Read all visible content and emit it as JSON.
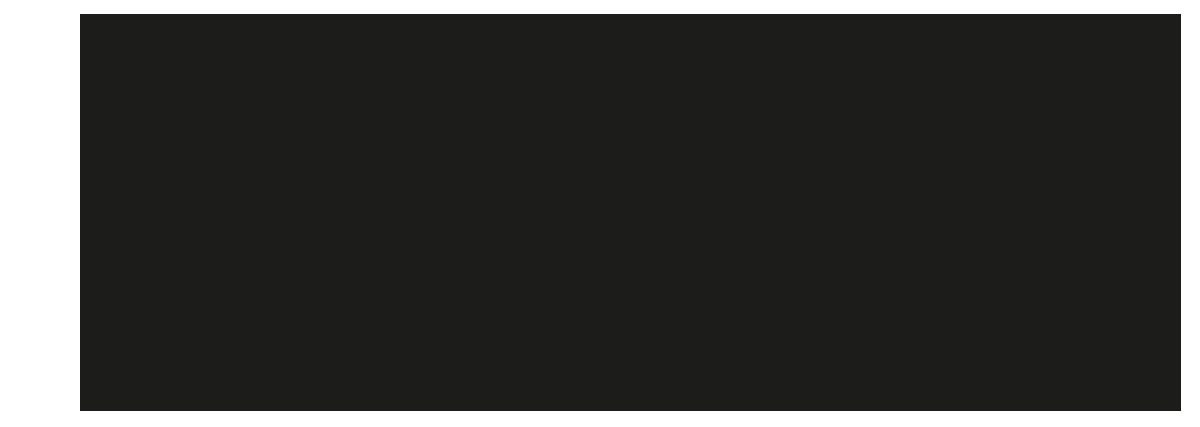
{
  "canvas": {
    "background_color": "#ffffff"
  },
  "screen": {
    "panel_color": "#1c1c1a",
    "content": "",
    "state": "blank"
  }
}
